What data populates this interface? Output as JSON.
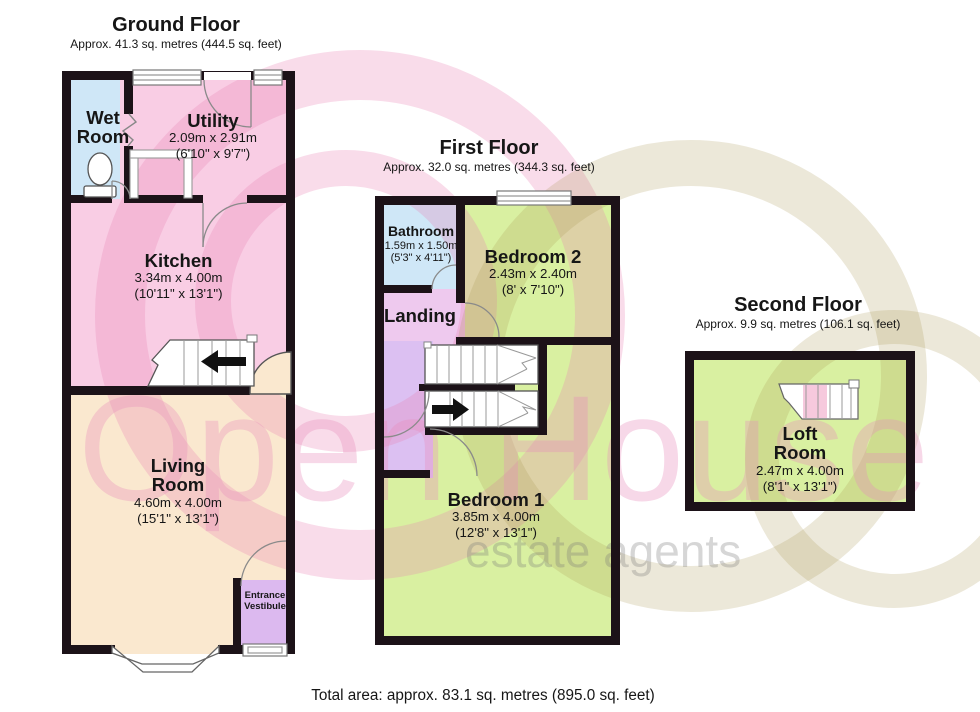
{
  "watermark": {
    "brand": "Open House",
    "tagline": "estate agents"
  },
  "footer": {
    "total": "Total area: approx. 83.1 sq. metres (895.0 sq. feet)"
  },
  "floors": {
    "ground": {
      "title": "Ground Floor",
      "subtitle": "Approx. 41.3 sq. metres (444.5 sq. feet)",
      "rooms": {
        "wet_room": {
          "name": "Wet Room"
        },
        "utility": {
          "name": "Utility",
          "dims_m": "2.09m x 2.91m",
          "dims_ft": "(6'10\" x 9'7\")"
        },
        "kitchen": {
          "name": "Kitchen",
          "dims_m": "3.34m x 4.00m",
          "dims_ft": "(10'11\" x 13'1\")"
        },
        "living_room": {
          "name": "Living Room",
          "dims_m": "4.60m x 4.00m",
          "dims_ft": "(15'1\" x 13'1\")"
        },
        "entrance_vestibule": {
          "name": "Entrance Vestibule"
        }
      }
    },
    "first": {
      "title": "First Floor",
      "subtitle": "Approx. 32.0 sq. metres (344.3 sq. feet)",
      "rooms": {
        "bathroom": {
          "name": "Bathroom",
          "dims_m": "1.59m x 1.50m",
          "dims_ft": "(5'3\" x 4'11\")"
        },
        "bedroom2": {
          "name": "Bedroom 2",
          "dims_m": "2.43m x 2.40m",
          "dims_ft": "(8' x 7'10\")"
        },
        "landing": {
          "name": "Landing"
        },
        "bedroom1": {
          "name": "Bedroom 1",
          "dims_m": "3.85m x 4.00m",
          "dims_ft": "(12'8\" x 13'1\")"
        }
      }
    },
    "second": {
      "title": "Second Floor",
      "subtitle": "Approx. 9.9 sq. metres (106.1 sq. feet)",
      "rooms": {
        "loft_room": {
          "name": "Loft Room",
          "dims_m": "2.47m x 4.00m",
          "dims_ft": "(8'1\" x 13'1\")"
        }
      }
    }
  },
  "colors": {
    "wall": "#1c1218",
    "pink_room": "#f9cde4",
    "blue_room": "#cfe7f7",
    "cream_room": "#fae8cf",
    "purple_room": "#dcb9ef",
    "lavender_room": "#eec9ee",
    "corridor_room": "#dcc0f2",
    "green_room": "#d9f0a1",
    "stair_pink": "#f6c9dd",
    "watermark_pink": "rgba(232,130,180,0.28)",
    "watermark_olive": "rgba(168,148,80,0.22)",
    "watermark_brand": "rgba(233,140,188,0.34)",
    "watermark_gray": "rgba(120,120,120,0.30)"
  }
}
